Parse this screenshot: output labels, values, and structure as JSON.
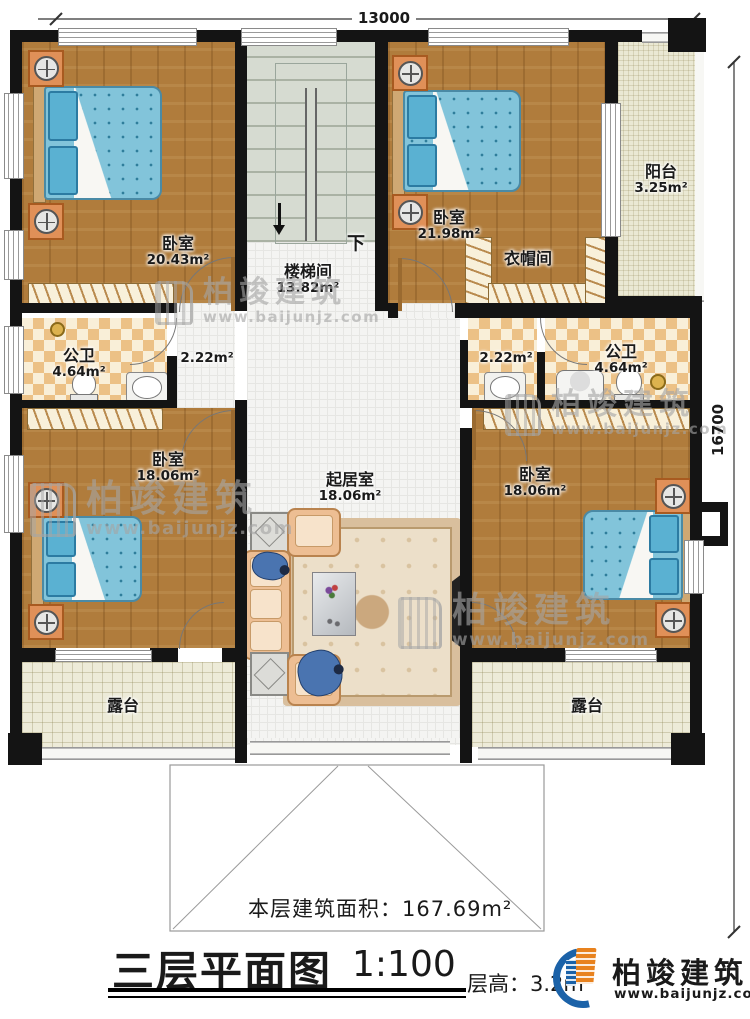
{
  "plan": {
    "dim_top": "13000",
    "dim_right": "16700",
    "stair_label": "下",
    "rooms": {
      "bedroom_tl": {
        "name": "卧室",
        "area": "20.43m²"
      },
      "stairwell": {
        "name": "楼梯间",
        "area": "13.82m²"
      },
      "bedroom_tr": {
        "name": "卧室",
        "area": "21.98m²"
      },
      "cloakroom": {
        "name": "衣帽间"
      },
      "balcony": {
        "name": "阳台",
        "area": "3.25m²"
      },
      "bath_left": {
        "name": "公卫",
        "area": "4.64m²"
      },
      "hall_left": {
        "area": "2.22m²"
      },
      "hall_right": {
        "area": "2.22m²"
      },
      "bath_right": {
        "name": "公卫",
        "area": "4.64m²"
      },
      "bedroom_bl": {
        "name": "卧室",
        "area": "18.06m²"
      },
      "living": {
        "name": "起居室",
        "area": "18.06m²"
      },
      "bedroom_br": {
        "name": "卧室",
        "area": "18.06m²"
      },
      "terrace_left": {
        "name": "露台"
      },
      "terrace_right": {
        "name": "露台"
      }
    }
  },
  "annotations": {
    "floor_area_label": "本层建筑面积：",
    "floor_area_value": "167.69m²",
    "title": "三层平面图",
    "scale": "1:100",
    "floor_height_label": "层高：",
    "floor_height_value": "3.2m"
  },
  "branding": {
    "name": "柏竣建筑",
    "url": "www.baijunjz.com"
  }
}
